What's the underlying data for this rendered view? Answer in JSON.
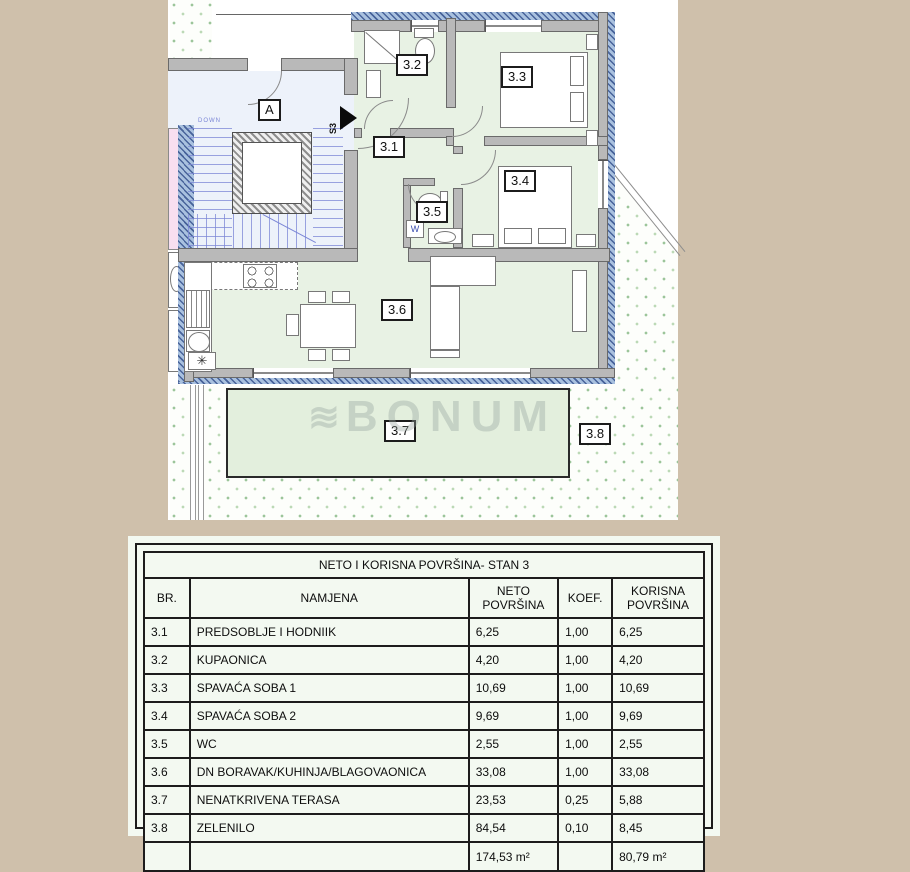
{
  "plan": {
    "labels": {
      "a": "A",
      "s3": "S3",
      "down": "DOWN",
      "r31": "3.1",
      "r32": "3.2",
      "r33": "3.3",
      "r34": "3.4",
      "r35": "3.5",
      "r36": "3.6",
      "r37": "3.7",
      "r38": "3.8"
    },
    "glyphs": {
      "washer": "W",
      "fridge": "✳"
    }
  },
  "watermark": {
    "logo": "≋",
    "text": "BONUM"
  },
  "table": {
    "title": "NETO I KORISNA POVRŠINA- STAN 3",
    "headers": {
      "br": "BR.",
      "namjena": "NAMJENA",
      "neto": "NETO POVRŠINA",
      "koef": "KOEF.",
      "korisna": "KORISNA POVRŠINA"
    },
    "rows": [
      {
        "br": "3.1",
        "namjena": "PREDSOBLJE I HODNIIK",
        "neto": "6,25",
        "koef": "1,00",
        "korisna": "6,25"
      },
      {
        "br": "3.2",
        "namjena": "KUPAONICA",
        "neto": "4,20",
        "koef": "1,00",
        "korisna": "4,20"
      },
      {
        "br": "3.3",
        "namjena": "SPAVAĆA SOBA 1",
        "neto": "10,69",
        "koef": "1,00",
        "korisna": "10,69"
      },
      {
        "br": "3.4",
        "namjena": "SPAVAĆA SOBA 2",
        "neto": "9,69",
        "koef": "1,00",
        "korisna": "9,69"
      },
      {
        "br": "3.5",
        "namjena": "WC",
        "neto": "2,55",
        "koef": "1,00",
        "korisna": "2,55"
      },
      {
        "br": "3.6",
        "namjena": "DN BORAVAK/KUHINJA/BLAGOVAONICA",
        "neto": "33,08",
        "koef": "1,00",
        "korisna": "33,08"
      },
      {
        "br": "3.7",
        "namjena": "NENATKRIVENA TERASA",
        "neto": "23,53",
        "koef": "0,25",
        "korisna": "5,88"
      },
      {
        "br": "3.8",
        "namjena": "ZELENILO",
        "neto": "84,54",
        "koef": "0,10",
        "korisna": "8,45"
      }
    ],
    "total": {
      "neto": "174,53 m²",
      "korisna": "80,79 m²"
    }
  },
  "colors": {
    "page_background": "#cfc0ab",
    "room_green": "#e8f2e4",
    "terrace_green": "#e3efdd",
    "stairwell_blue": "#edf2fa",
    "exterior_wall_hatch_blue": "#48639a",
    "stairs_line_blue": "#7b86d6",
    "adjacent_unit_pink": "#f8dff0",
    "wall_gray": "#b9b9b9",
    "table_background": "#f3f9f1"
  }
}
